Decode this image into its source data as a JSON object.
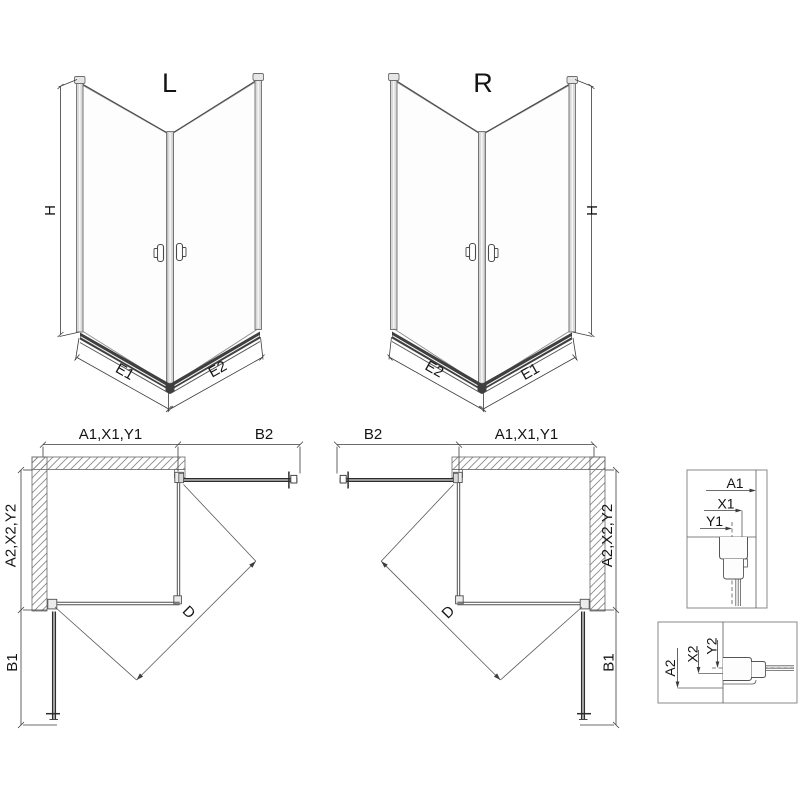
{
  "page": {
    "background": "#ffffff",
    "type": "technical-drawing",
    "subject": "corner shower enclosure installation diagram"
  },
  "colors": {
    "line": "#3c3c3c",
    "glass_edge": "#8c8c8c",
    "profile_fill": "#d9d9d9",
    "rail_fill": "#3f3f3f",
    "hatch": "#858585",
    "text": "#141414"
  },
  "iso_views": [
    {
      "title": "L",
      "dim_height": "H",
      "dim_bottom_left": "E1",
      "dim_bottom_right": "E2"
    },
    {
      "title": "R",
      "dim_height": "H",
      "dim_bottom_left": "E2",
      "dim_bottom_right": "E1"
    }
  ],
  "plan_views": [
    {
      "dim_top_width": "A1,X1,Y1",
      "dim_top_door": "B2",
      "dim_side_depth": "A2,X2,Y2",
      "dim_side_door": "B1",
      "dim_diagonal": "D"
    },
    {
      "dim_top_width": "A1,X1,Y1",
      "dim_top_door": "B2",
      "dim_side_depth": "A2,X2,Y2",
      "dim_side_door": "B1",
      "dim_diagonal": "D"
    }
  ],
  "detail_views": [
    {
      "dims": [
        "A1",
        "X1",
        "Y1"
      ]
    },
    {
      "dims": [
        "A2",
        "X2",
        "Y2"
      ]
    }
  ]
}
